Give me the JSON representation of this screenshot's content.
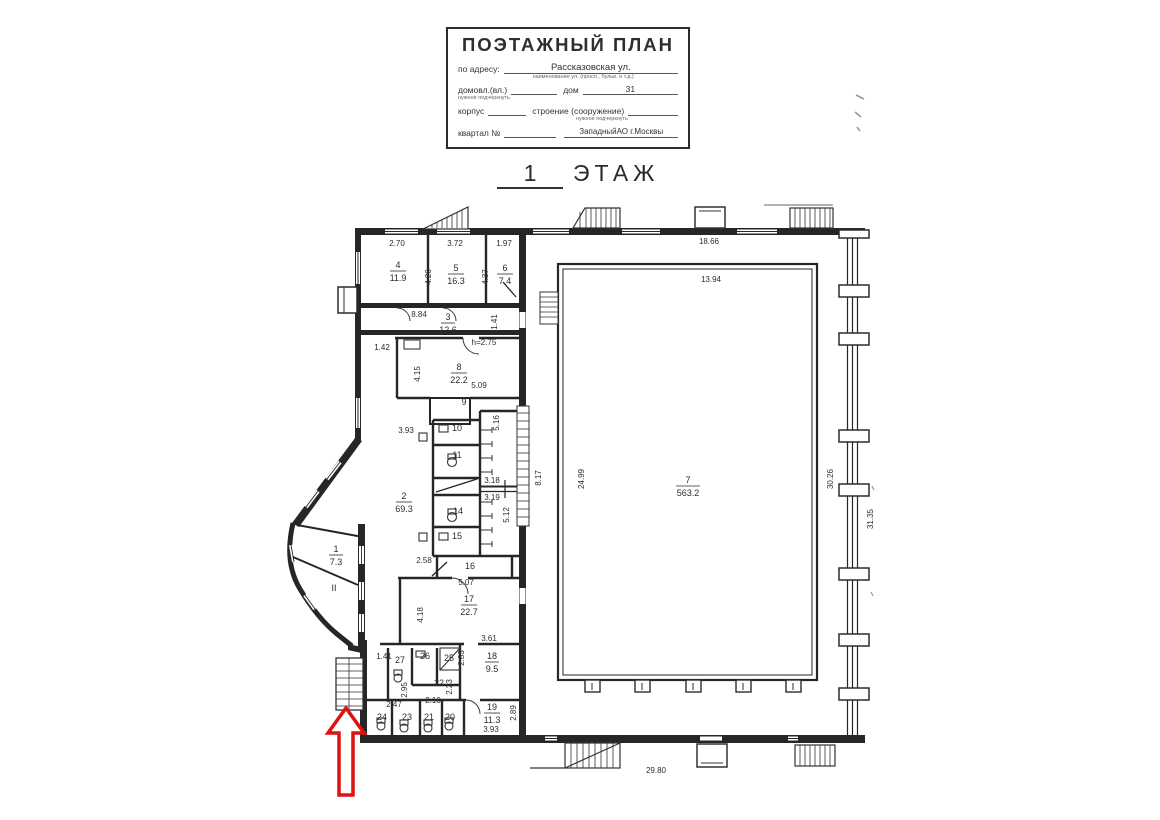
{
  "title_block": {
    "title": "ПОЭТАЖНЫЙ ПЛАН",
    "address_label": "по адресу:",
    "address_value": "Рассказовская ул.",
    "address_caption": "наименование ул. (просп., бульв. и т.д.)",
    "ownership_label": "домовл.(вл.)",
    "ownership_caption": "нужное подчеркнуть",
    "house_label": "дом",
    "house_value": "31",
    "building_label": "корпус",
    "structure_label": "строение (сооружение)",
    "structure_caption": "нужное подчеркнуть",
    "quarter_label": "квартал №",
    "district_value": "ЗападныйАО г.Москвы"
  },
  "floor_heading": {
    "number": "1",
    "word": "ЭТАЖ"
  },
  "colors": {
    "arrow_red": "#dd1212"
  },
  "plan": {
    "rooms": {
      "r1": {
        "num": "1",
        "area": "7.3"
      },
      "r2": {
        "num": "2",
        "area": "69.3"
      },
      "r3": {
        "num": "3",
        "area": "12.6"
      },
      "r4": {
        "num": "4",
        "area": "11.9"
      },
      "r5": {
        "num": "5",
        "area": "16.3"
      },
      "r6": {
        "num": "6",
        "area": "7.4"
      },
      "r7": {
        "num": "7",
        "area": "563.2"
      },
      "r8": {
        "num": "8",
        "area": "22.2"
      },
      "r9": {
        "num": "9"
      },
      "r10": {
        "num": "10"
      },
      "r11": {
        "num": "11"
      },
      "r14": {
        "num": "14"
      },
      "r15": {
        "num": "15"
      },
      "r16": {
        "num": "16"
      },
      "r17": {
        "num": "17",
        "area": "22.7"
      },
      "r18": {
        "num": "18",
        "area": "9.5"
      },
      "r19": {
        "num": "19",
        "area": "11.3"
      },
      "r20": {
        "num": "20"
      },
      "r21": {
        "num": "21"
      },
      "r22": {
        "num": "22"
      },
      "r23": {
        "num": "23"
      },
      "r24": {
        "num": "24"
      },
      "r25": {
        "num": "25"
      },
      "r26": {
        "num": "26"
      },
      "r27": {
        "num": "27"
      },
      "zone2": "II"
    },
    "dims": {
      "d270": "2.70",
      "d372": "3.72",
      "d197": "1.97",
      "d426": "4.26",
      "d437": "4.37",
      "d884": "8.84",
      "d141a": "1.41",
      "d142": "1.42",
      "h275": "h=2.75",
      "d415": "4.15",
      "d509": "5.09",
      "d393a": "3.93",
      "d516": "5.16",
      "d318": "3.18",
      "d319": "3.19",
      "d512": "5.12",
      "d258": "2.58",
      "d507": "5.07",
      "d418": "4.18",
      "d361": "3.61",
      "d283": "2.83",
      "d141b": "1.41",
      "d295": "2.95",
      "d223": "2.23",
      "d210": "2.10",
      "d247": "2.47",
      "d289": "2.89",
      "d393b": "3.93",
      "d817": "8.17",
      "d2499": "24.99",
      "d1866": "18.66",
      "d1394": "13.94",
      "d3026": "30.26",
      "d3135": "31.35",
      "d2980": "29.80"
    }
  }
}
